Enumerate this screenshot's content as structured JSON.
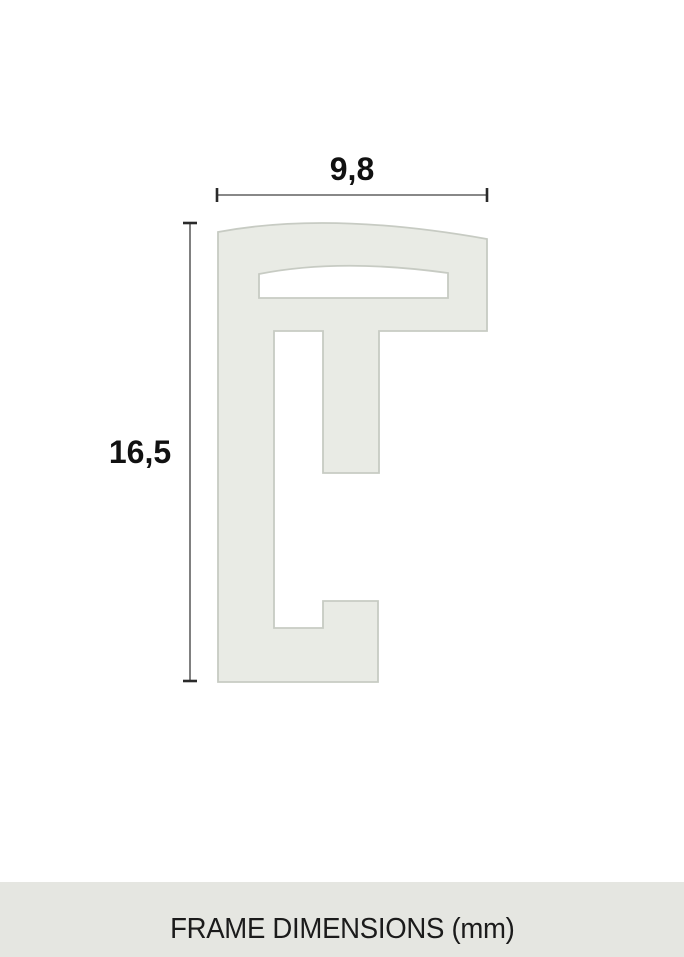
{
  "diagram": {
    "type": "frame-profile-cross-section",
    "width_label": "9,8",
    "height_label": "16,5",
    "width_mm": 9.8,
    "height_mm": 16.5,
    "unit": "mm"
  },
  "caption": {
    "text": "FRAME DIMENSIONS (mm)"
  },
  "colors": {
    "background": "#ffffff",
    "profile_fill": "#e9ebe5",
    "profile_border": "#c7cbc3",
    "caption_bar_bg": "#e5e6e1",
    "dim_line": "#616161",
    "dim_tick": "#2a2a2a",
    "label_text": "#111111",
    "caption_text": "#1b1b1b"
  }
}
